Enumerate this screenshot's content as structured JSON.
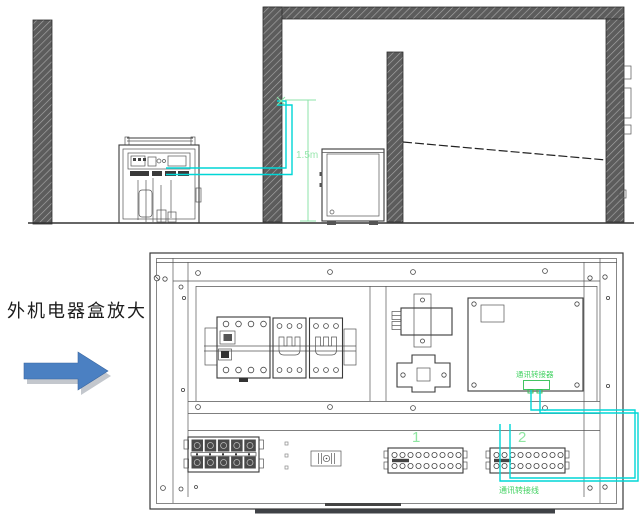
{
  "callout": {
    "label": "外机电器盒放大"
  },
  "top_drawing": {
    "dimension_label": "1.5m",
    "wire_color": "#00d6d6",
    "dimension_color": "#8ce3a8"
  },
  "enlarged_box": {
    "terminal_block_1_label": "1",
    "terminal_block_2_label": "2",
    "pcb_label": "通讯转接器",
    "bottom_wire_label": "通讯转接线",
    "label_color": "#40d160",
    "wire_color": "#00d6d6",
    "arrow_color": "#4b80c2"
  }
}
